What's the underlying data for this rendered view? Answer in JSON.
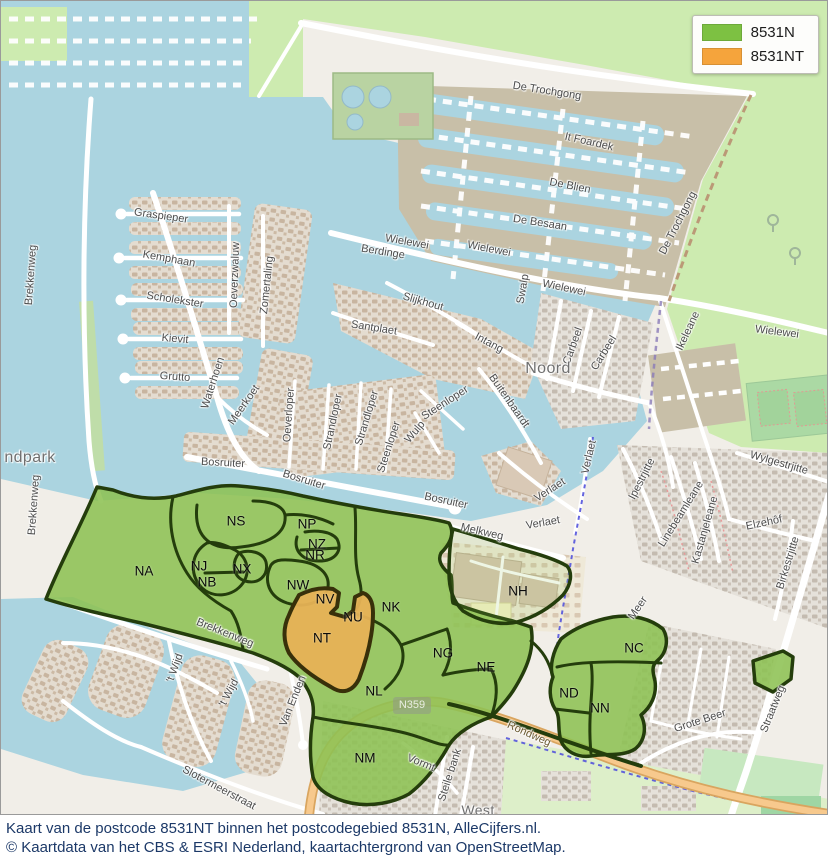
{
  "legend": {
    "items": [
      {
        "label": "8531N",
        "color": "#7DC142"
      },
      {
        "label": "8531NT",
        "color": "#F5A43C"
      }
    ]
  },
  "caption": {
    "line1": "Kaart van de postcode 8531NT binnen het postcodegebied 8531N, AlleCijfers.nl.",
    "line2": "© Kaartdata van het CBS & ESRI Nederland, kaartachtergrond van OpenStreetMap."
  },
  "map": {
    "road_shield": "N359",
    "colors": {
      "overlay_green": "#8DC153",
      "overlay_orange": "#E7B256",
      "overlay_border": "#243D0C",
      "water": "#ABD4E0",
      "grass": "#CDEBB0",
      "marina": "#C8BFA8",
      "caption_text": "#1C3968"
    },
    "place_labels": [
      {
        "text": "ndpark",
        "x": 29,
        "y": 457,
        "rot": 0,
        "size": 16
      },
      {
        "text": "Noord",
        "x": 547,
        "y": 368,
        "rot": 0,
        "size": 16
      },
      {
        "text": "West",
        "x": 477,
        "y": 809,
        "rot": 0,
        "size": 14
      }
    ],
    "street_labels": [
      {
        "text": "De Trochgong",
        "x": 546,
        "y": 90,
        "rot": 9
      },
      {
        "text": "It Foardek",
        "x": 588,
        "y": 141,
        "rot": 13
      },
      {
        "text": "De Blien",
        "x": 569,
        "y": 185,
        "rot": 11
      },
      {
        "text": "De Besaan",
        "x": 539,
        "y": 222,
        "rot": 9
      },
      {
        "text": "Wielewei",
        "x": 406,
        "y": 241,
        "rot": 10
      },
      {
        "text": "Wielewei",
        "x": 488,
        "y": 248,
        "rot": 11
      },
      {
        "text": "Berdinge",
        "x": 382,
        "y": 251,
        "rot": 9
      },
      {
        "text": "Wielewei",
        "x": 563,
        "y": 287,
        "rot": 12
      },
      {
        "text": "Swalp",
        "x": 522,
        "y": 288,
        "rot": -80
      },
      {
        "text": "Wielewei",
        "x": 776,
        "y": 331,
        "rot": 7
      },
      {
        "text": "De Trochgong",
        "x": 677,
        "y": 222,
        "rot": -63
      },
      {
        "text": "Ikeleane",
        "x": 687,
        "y": 330,
        "rot": -65
      },
      {
        "text": "Graspieper",
        "x": 160,
        "y": 215,
        "rot": 8
      },
      {
        "text": "Kemphaan",
        "x": 168,
        "y": 258,
        "rot": 10
      },
      {
        "text": "Scholekster",
        "x": 174,
        "y": 299,
        "rot": 9
      },
      {
        "text": "Kievit",
        "x": 174,
        "y": 338,
        "rot": 5
      },
      {
        "text": "Grutto",
        "x": 174,
        "y": 376,
        "rot": 4
      },
      {
        "text": "Brekkenweg",
        "x": 30,
        "y": 274,
        "rot": -86
      },
      {
        "text": "Brekkenweg",
        "x": 33,
        "y": 504,
        "rot": -86
      },
      {
        "text": "Brekkenweg",
        "x": 224,
        "y": 632,
        "rot": 22
      },
      {
        "text": "Oeverzwaluw",
        "x": 234,
        "y": 274,
        "rot": -88
      },
      {
        "text": "Zomertaling",
        "x": 266,
        "y": 284,
        "rot": -84
      },
      {
        "text": "Waterhoen",
        "x": 212,
        "y": 382,
        "rot": -72
      },
      {
        "text": "Meerkoet",
        "x": 243,
        "y": 404,
        "rot": -55
      },
      {
        "text": "Oeverloper",
        "x": 288,
        "y": 414,
        "rot": -86
      },
      {
        "text": "Slijkhout",
        "x": 422,
        "y": 301,
        "rot": 16
      },
      {
        "text": "Santplaet",
        "x": 373,
        "y": 327,
        "rot": 9
      },
      {
        "text": "Intang",
        "x": 488,
        "y": 342,
        "rot": 28
      },
      {
        "text": "Carbeel",
        "x": 572,
        "y": 345,
        "rot": -70
      },
      {
        "text": "Carbeel",
        "x": 603,
        "y": 352,
        "rot": -58
      },
      {
        "text": "Buitenbaardt",
        "x": 508,
        "y": 400,
        "rot": 55
      },
      {
        "text": "Steenloper",
        "x": 444,
        "y": 402,
        "rot": -33
      },
      {
        "text": "Steenloper",
        "x": 388,
        "y": 446,
        "rot": -72
      },
      {
        "text": "Wulp",
        "x": 414,
        "y": 431,
        "rot": -50
      },
      {
        "text": "Strandloper",
        "x": 332,
        "y": 421,
        "rot": -78
      },
      {
        "text": "Strandloper",
        "x": 366,
        "y": 417,
        "rot": -73
      },
      {
        "text": "Bosruiter",
        "x": 222,
        "y": 462,
        "rot": 3
      },
      {
        "text": "Bosruiter",
        "x": 303,
        "y": 479,
        "rot": 17
      },
      {
        "text": "Bosruiter",
        "x": 445,
        "y": 500,
        "rot": 12
      },
      {
        "text": "Verlaet",
        "x": 549,
        "y": 489,
        "rot": -33
      },
      {
        "text": "Verlaet",
        "x": 588,
        "y": 456,
        "rot": -77
      },
      {
        "text": "Verlaet",
        "x": 542,
        "y": 522,
        "rot": -10
      },
      {
        "text": "Melkweg",
        "x": 481,
        "y": 531,
        "rot": 13
      },
      {
        "text": "Ipestrjitte",
        "x": 641,
        "y": 478,
        "rot": -63
      },
      {
        "text": "Linebeamleane",
        "x": 680,
        "y": 513,
        "rot": -58
      },
      {
        "text": "Kastanjeleane",
        "x": 704,
        "y": 529,
        "rot": -74
      },
      {
        "text": "Elzehôf",
        "x": 763,
        "y": 522,
        "rot": -12
      },
      {
        "text": "Wylgestrjitte",
        "x": 778,
        "y": 462,
        "rot": 16
      },
      {
        "text": "Birkestrjitte",
        "x": 787,
        "y": 562,
        "rot": -73
      },
      {
        "text": "Straatweg",
        "x": 772,
        "y": 708,
        "rot": -68
      },
      {
        "text": "Grote Beer",
        "x": 699,
        "y": 720,
        "rot": -18
      },
      {
        "text": "Meer",
        "x": 637,
        "y": 607,
        "rot": -55
      },
      {
        "text": "'t Wijd",
        "x": 174,
        "y": 667,
        "rot": -70
      },
      {
        "text": "'t Wijd",
        "x": 228,
        "y": 692,
        "rot": -62
      },
      {
        "text": "Van Enden",
        "x": 292,
        "y": 700,
        "rot": -68
      },
      {
        "text": "Slotermeerstraat",
        "x": 218,
        "y": 787,
        "rot": 28
      },
      {
        "text": "Vormt",
        "x": 420,
        "y": 762,
        "rot": 22
      },
      {
        "text": "Steile bank",
        "x": 449,
        "y": 774,
        "rot": -72
      },
      {
        "text": "Rondweg",
        "x": 528,
        "y": 733,
        "rot": 24,
        "kind": "onroad"
      }
    ]
  },
  "regions": {
    "postcode_parent": "8531N",
    "postcode_highlight": "8531NT",
    "labels": [
      {
        "code": "NS",
        "x": 235,
        "y": 520
      },
      {
        "code": "NP",
        "x": 306,
        "y": 523
      },
      {
        "code": "NZ",
        "x": 316,
        "y": 543
      },
      {
        "code": "NR",
        "x": 314,
        "y": 554
      },
      {
        "code": "NA",
        "x": 143,
        "y": 570
      },
      {
        "code": "NJ",
        "x": 198,
        "y": 565
      },
      {
        "code": "NB",
        "x": 206,
        "y": 581
      },
      {
        "code": "NX",
        "x": 241,
        "y": 568
      },
      {
        "code": "NW",
        "x": 297,
        "y": 584
      },
      {
        "code": "NV",
        "x": 324,
        "y": 598
      },
      {
        "code": "NU",
        "x": 352,
        "y": 616
      },
      {
        "code": "NK",
        "x": 390,
        "y": 606
      },
      {
        "code": "NT",
        "x": 321,
        "y": 637
      },
      {
        "code": "NG",
        "x": 442,
        "y": 652
      },
      {
        "code": "NE",
        "x": 485,
        "y": 666
      },
      {
        "code": "NL",
        "x": 373,
        "y": 690
      },
      {
        "code": "NM",
        "x": 364,
        "y": 757
      },
      {
        "code": "NH",
        "x": 517,
        "y": 590
      },
      {
        "code": "NC",
        "x": 633,
        "y": 647
      },
      {
        "code": "ND",
        "x": 568,
        "y": 692
      },
      {
        "code": "NN",
        "x": 599,
        "y": 707
      }
    ]
  }
}
